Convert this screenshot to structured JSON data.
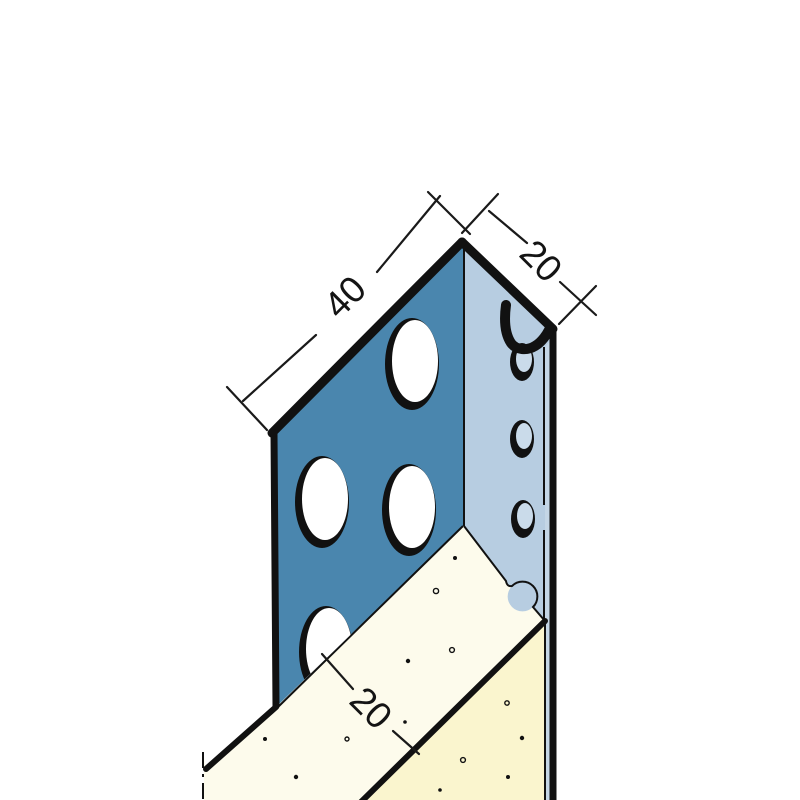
{
  "figure": {
    "dimension_labels": {
      "flange_width": "40",
      "return_depth": "20",
      "board_thickness": "20"
    }
  },
  "colors": {
    "background": "#ffffff",
    "flange_blue": "#4a86ae",
    "face_blue": "#b7cde1",
    "hem_strip_blue": "#c4d6e6",
    "board_top_cream": "#fdfbec",
    "board_front_cream": "#faf5ce",
    "hole_white": "#ffffff",
    "oval_inner_blue": "#cadbea",
    "outline_black": "#111111"
  }
}
